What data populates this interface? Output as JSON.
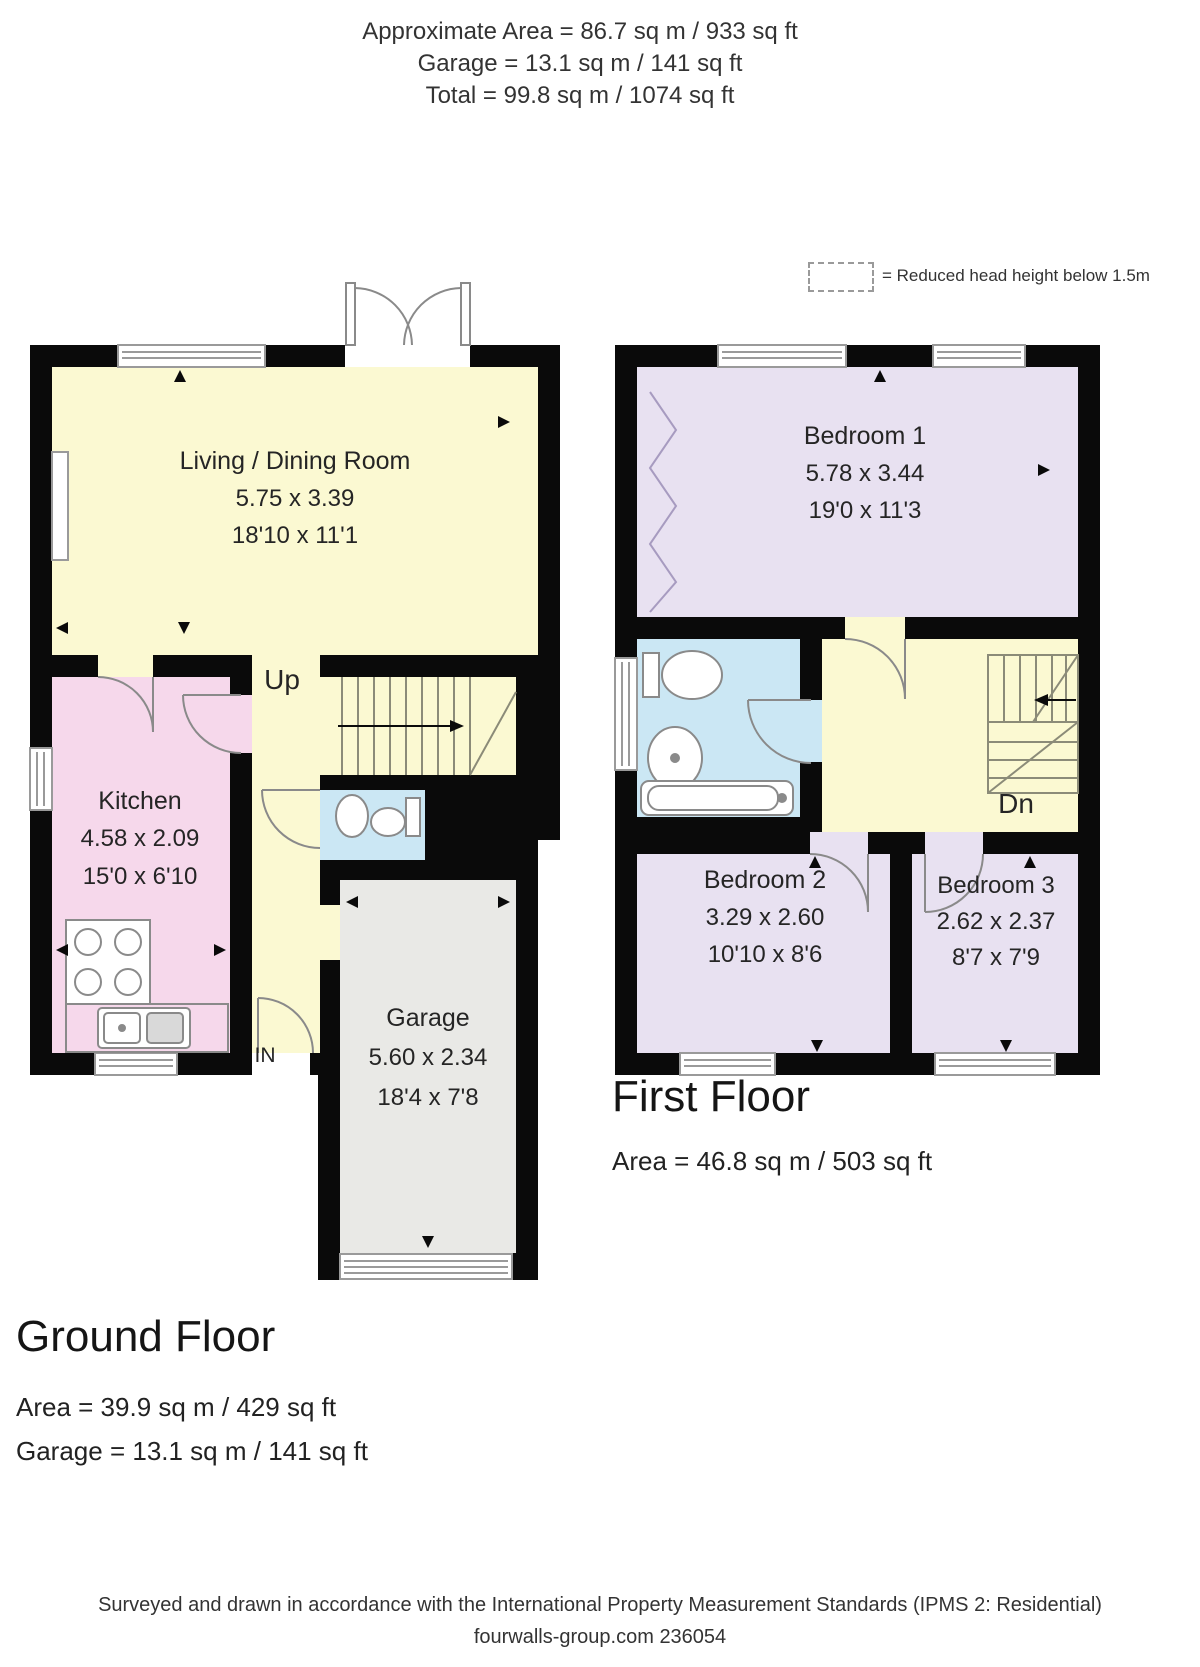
{
  "header": {
    "approximate": "Approximate  Area = 86.7 sq m / 933 sq ft",
    "garage": "Garage = 13.1 sq m / 141 sq ft",
    "total": "Total = 99.8 sq m / 1074 sq ft"
  },
  "legend": {
    "reduced_head_height": "= Reduced head height below 1.5m"
  },
  "ground_floor": {
    "title": "Ground Floor",
    "area": "Area = 39.9 sq m / 429 sq ft",
    "garage_area": "Garage = 13.1 sq m / 141 sq ft",
    "labels": {
      "up": "Up",
      "in": "IN"
    },
    "rooms": {
      "living_dining": {
        "name": "Living / Dining Room",
        "size_m": "5.75 x 3.39",
        "size_ft": "18'10 x 11'1"
      },
      "kitchen": {
        "name": "Kitchen",
        "size_m": "4.58 x 2.09",
        "size_ft": "15'0 x 6'10"
      },
      "garage": {
        "name": "Garage",
        "size_m": "5.60 x 2.34",
        "size_ft": "18'4 x 7'8"
      }
    }
  },
  "first_floor": {
    "title": "First Floor",
    "area": "Area = 46.8 sq m / 503 sq ft",
    "labels": {
      "down": "Dn"
    },
    "rooms": {
      "bedroom1": {
        "name": "Bedroom 1",
        "size_m": "5.78 x 3.44",
        "size_ft": "19'0 x 11'3"
      },
      "bedroom2": {
        "name": "Bedroom 2",
        "size_m": "3.29 x 2.60",
        "size_ft": "10'10 x 8'6"
      },
      "bedroom3": {
        "name": "Bedroom 3",
        "size_m": "2.62 x 2.37",
        "size_ft": "8'7 x 7'9"
      }
    }
  },
  "footer": {
    "standards": "Surveyed and drawn in accordance with the International Property Measurement Standards (IPMS 2: Residential)",
    "credit": "fourwalls-group.com 236054"
  },
  "colors": {
    "room_yellow": "#FBF9D2",
    "room_pink": "#F6D8EB",
    "room_lavender": "#E8E1F1",
    "room_blue": "#CBE7F4",
    "room_gray": "#E9E9E6",
    "wall": "#0a0a0a"
  }
}
